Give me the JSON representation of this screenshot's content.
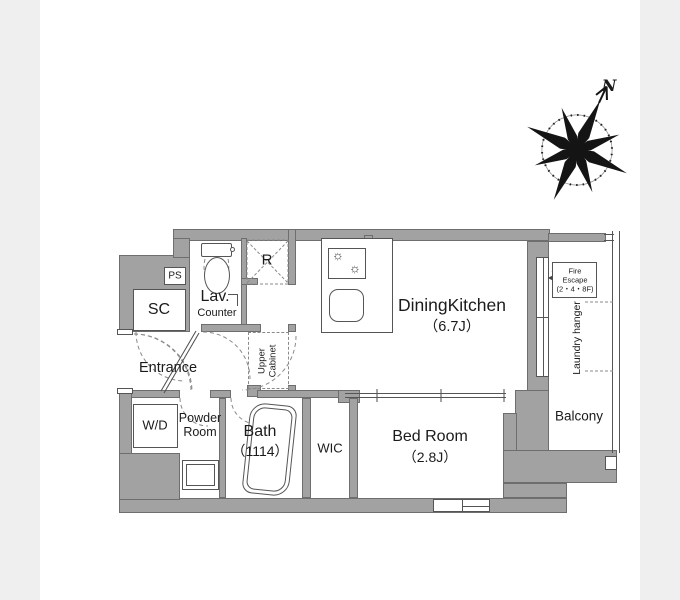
{
  "palette": {
    "canvas": "#ffffff",
    "side_band": "#efefef",
    "wall_fill": "#a2a2a2",
    "wall_edge": "#6e6e6e",
    "thin_line": "#555555",
    "dash_line": "#8a8a8a",
    "text": "#1b1b1b"
  },
  "compass": {
    "north_label": "N"
  },
  "plan": {
    "labels": {
      "ps": "PS",
      "sc": "SC",
      "lav": "Lav.",
      "counter": "Counter",
      "r": "R",
      "dining_kitchen": "DiningKitchen",
      "dining_kitchen_size": "（6.7J）",
      "entrance": "Entrance",
      "upper_cabinet_1": "Upper",
      "upper_cabinet_2": "Cabinet",
      "wd": "W/D",
      "powder_1": "Powder",
      "powder_2": "Room",
      "bath": "Bath",
      "bath_size": "（1114）",
      "wic": "WIC",
      "bed_room": "Bed Room",
      "bed_room_size": "（2.8J）",
      "balcony": "Balcony",
      "laundry_hanger": "Laundry hanger",
      "fire_escape_1": "Fire",
      "fire_escape_2": "Escape",
      "fire_escape_3": "(2・4・8F)",
      "fire_escape_arrow": "◀"
    }
  }
}
